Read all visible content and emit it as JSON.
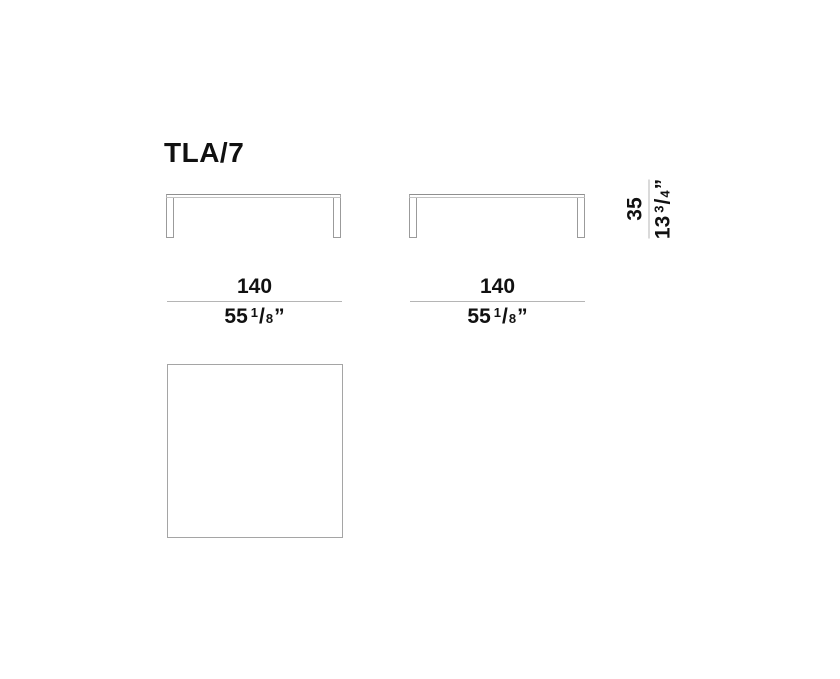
{
  "title": "TLA/7",
  "dimensions": {
    "width_front": {
      "metric_cm": "140",
      "imperial_whole": "55",
      "fraction_numerator": "1",
      "fraction_slash": "/",
      "fraction_denominator": "8",
      "unit_mark": "”"
    },
    "width_side": {
      "metric_cm": "140",
      "imperial_whole": "55",
      "fraction_numerator": "1",
      "fraction_slash": "/",
      "fraction_denominator": "8",
      "unit_mark": "”"
    },
    "height": {
      "metric_cm": "35",
      "imperial_whole": "13",
      "fraction_numerator": "3",
      "fraction_slash": "/",
      "fraction_denominator": "4",
      "unit_mark": "”"
    }
  },
  "colors": {
    "text": "#111111",
    "drawing_outline": "#9b9b9b",
    "dimension_line": "#b5b5b5",
    "background": "#ffffff"
  }
}
